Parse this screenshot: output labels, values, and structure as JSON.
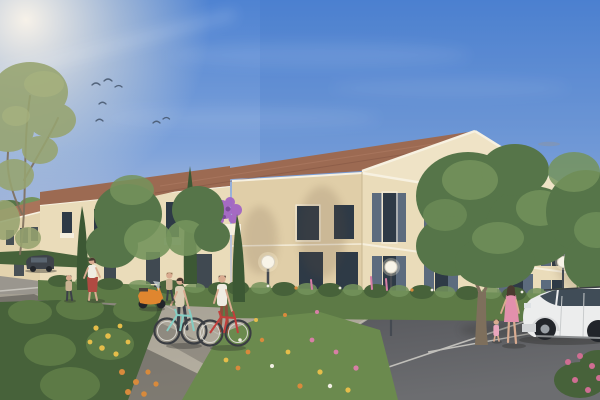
{
  "meta": {
    "title": "residential-building-exterior-render",
    "description": "Architectural 3D rendering: two-storey cream apartment residences with terracotta tiled roofs, white cornices and slate-blue shuttered windows, fronted by flowering hedges, cypresses and street trees. A woman walks with a child, two cyclists stand by a mint and a red bicycle near an orange scooter, a woman in a pink dress leads a toddler past a white parked car in the parking area, under a blue sky with birds and a low warm sun from the upper left."
  },
  "scene": {
    "buildings": {
      "count": 3,
      "storeys": 2,
      "style": "provencal residence, cream stucco, terracotta roof, slate shutters, white cornice"
    },
    "people": [
      "woman walking with child",
      "cyclist woman with mint bike",
      "cyclist man with red bike",
      "child beside scooter",
      "woman in pink dress with toddler"
    ],
    "vehicles": [
      "orange scooter",
      "white compact car",
      "dark parked car"
    ],
    "landscape": [
      "airy left foreground tree",
      "two street trees",
      "large centre tree",
      "right edge tree",
      "three cypresses",
      "flowering hedges",
      "wildflower verge",
      "pink hollyhocks",
      "rose bush"
    ],
    "street_lamps_count": 3,
    "birds_count": 7,
    "lighting": "low warm sun upper-left, long diagonal shadows on pavement"
  },
  "colors": {
    "sky-top": "#4f83d2",
    "sky-mid": "#8fadde",
    "sky-haze": "#c9cfdf",
    "sky-horizon": "#f0ddc2",
    "sun-glow": "#fff7ea",
    "cloud-wisp": "#8d93a0",
    "bird": "#44556b",
    "roof-tile": "#9c6a52",
    "roof-tile-light": "#a8745a",
    "wall-cream": "#eadcba",
    "wall-cream-shade": "#e0cea8",
    "wall-gable": "#efe3c6",
    "wall-far": "#e3d3ae",
    "trim-white": "#f7f1e1",
    "glass-dark": "#2e3a46",
    "shutter-slate": "#5c6b7e",
    "hedge-green": "#5d7a46",
    "hedge-dark": "#47623a",
    "tree-green": "#567549",
    "tree-light": "#74935c",
    "cypress-green": "#3c5834",
    "foliage-olive": "#97a470",
    "grass-green": "#6b8a4e",
    "pavement": "#aba69b",
    "asphalt": "#5e5f64",
    "road-shadow": "#504f4a",
    "marking-white": "#d8d6cf",
    "lamp-globe": "#f8f4e8",
    "pole-grey": "#454a52",
    "trunk-brown": "#7e6f5c",
    "bike-teal": "#85cdc3",
    "bike-red": "#c23f3c",
    "scooter-orange": "#e0862f",
    "car-white": "#eceded",
    "car-dark": "#3e434a",
    "tire-black": "#22252a",
    "flower-purple": "#a265c4",
    "flower-pink": "#d77fa6",
    "flower-rose": "#cf6e92",
    "flower-yellow": "#e5bd4a",
    "flower-orange": "#d88a3c",
    "flower-white": "#f2efe4",
    "skin": "#d9ab90",
    "hair-dark": "#4a3a30",
    "shirt-white": "#efece2",
    "dress-pink": "#e290ac",
    "skirt-red": "#b04a42",
    "top-beige": "#d9cdb4",
    "pants-dark": "#3c4048",
    "pants-rust": "#8d4f3c",
    "child-tan": "#c9b393",
    "mailbox-yellow": "#d9b23a"
  }
}
